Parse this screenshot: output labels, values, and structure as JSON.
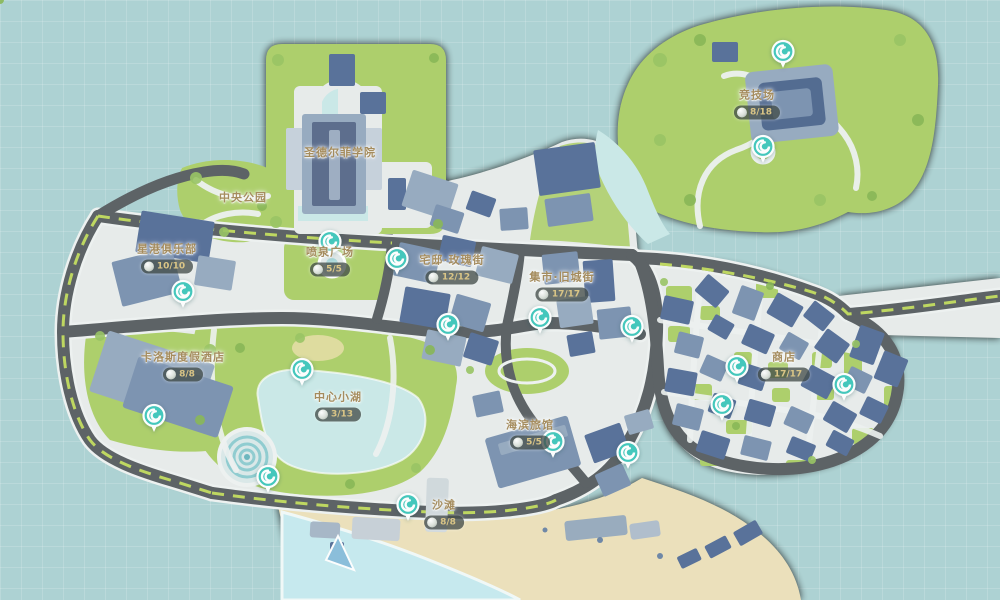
{
  "colors": {
    "water": "#a6cfd0",
    "land": "#e7ebea",
    "grass": "#a6cb5b",
    "road": "#4a5054",
    "lane_dash": "#b9d44e",
    "building": "#6f88a9",
    "building_dark": "#46618f",
    "lake": "#c6e8e6",
    "sea": "#c2e9ee",
    "sand": "#ecdfb4",
    "marker": "#2ec2b5",
    "label_gold": "#9c7f4a",
    "badge_bg": "#2f3934",
    "badge_text": "#d9c078"
  },
  "icons": {
    "marker": "swirl-teleport-icon",
    "badge": "collectible-orb-icon"
  },
  "areas": [
    {
      "name": "圣德尔菲学院",
      "count": null,
      "x": 340,
      "y": 152
    },
    {
      "name": "中央公园",
      "count": null,
      "x": 243,
      "y": 197
    },
    {
      "name": "星港俱乐部",
      "count": "10/10",
      "x": 167,
      "y": 258
    },
    {
      "name": "喷泉广场",
      "count": "5/5",
      "x": 330,
      "y": 261
    },
    {
      "name": "宅邸·玫瑰街",
      "count": "12/12",
      "x": 452,
      "y": 269
    },
    {
      "name": "集市·旧城街",
      "count": "17/17",
      "x": 562,
      "y": 286
    },
    {
      "name": "卡洛斯度假酒店",
      "count": "8/8",
      "x": 183,
      "y": 366
    },
    {
      "name": "中心小湖",
      "count": "3/13",
      "x": 338,
      "y": 406
    },
    {
      "name": "海滨旅馆",
      "count": "5/5",
      "x": 530,
      "y": 434
    },
    {
      "name": "商店",
      "count": "17/17",
      "x": 784,
      "y": 366
    },
    {
      "name": "沙滩",
      "count": "8/8",
      "x": 444,
      "y": 514
    },
    {
      "name": "竞技场",
      "count": "8/18",
      "x": 757,
      "y": 104
    }
  ],
  "markers": [
    {
      "x": 783,
      "y": 57
    },
    {
      "x": 763,
      "y": 152
    },
    {
      "x": 330,
      "y": 247
    },
    {
      "x": 397,
      "y": 264
    },
    {
      "x": 183,
      "y": 297
    },
    {
      "x": 448,
      "y": 330
    },
    {
      "x": 540,
      "y": 323
    },
    {
      "x": 632,
      "y": 332
    },
    {
      "x": 302,
      "y": 375
    },
    {
      "x": 154,
      "y": 421
    },
    {
      "x": 268,
      "y": 482
    },
    {
      "x": 408,
      "y": 510
    },
    {
      "x": 553,
      "y": 447
    },
    {
      "x": 628,
      "y": 458
    },
    {
      "x": 722,
      "y": 410
    },
    {
      "x": 737,
      "y": 372
    },
    {
      "x": 844,
      "y": 390
    }
  ]
}
